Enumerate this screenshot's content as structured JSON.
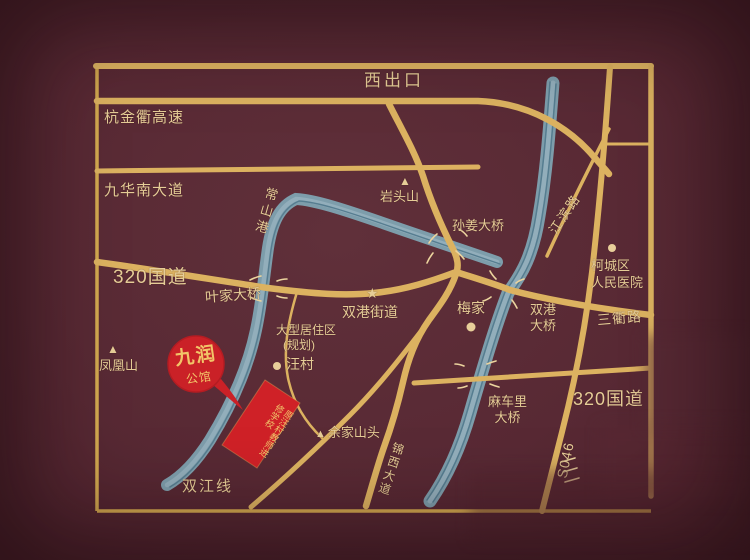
{
  "map_type": "real-estate location map",
  "colors": {
    "background": "#582934",
    "road_gold": "#dcb260",
    "frame_gold": "#d2a84f",
    "river_blue": "#7d9dab",
    "label_gold": "#e6cd97",
    "marker_red": "#ca2127",
    "marker_text_gold": "#f2c468"
  },
  "roads": {
    "west_exit": "西出口",
    "hangjinqu_expressway": "杭金衢高速",
    "jiuhua_south_avenue": "九华南大道",
    "g320_left": "320国道",
    "g320_right": "320国道",
    "jiangbin_road": "江滨路",
    "sanqu_road": "三衢路",
    "s046": "S046",
    "jinxi_avenue": "锦西大道",
    "shuangjiang_line": "双江线"
  },
  "bridges": {
    "yejia": "叶家大桥",
    "sunjiang": "孙姜大桥",
    "shuanggang_l1": "双港",
    "shuanggang_l2": "大桥",
    "macheli_l1": "麻车里",
    "macheli_l2": "大桥"
  },
  "river": {
    "changshan": "常山港"
  },
  "places": {
    "yantou_mountain": "岩头山",
    "fenghuang_mountain": "凤凰山",
    "yujia_hilltop": "余家山头",
    "wangcun": "汪村",
    "meijia": "梅家",
    "shuanggang_subdistrict": "双港街道",
    "kecheng_l1": "柯城区",
    "kecheng_l2": "人民医院",
    "residential_l1": "大型居住区",
    "residential_l2": "(规划)"
  },
  "property": {
    "name_l1": "九润",
    "name_l2": "公馆",
    "site_l1": "原汪村教师",
    "site_l2": "进修学校"
  },
  "icons": {
    "mountain": "▲",
    "star": "★",
    "dot": "●"
  }
}
